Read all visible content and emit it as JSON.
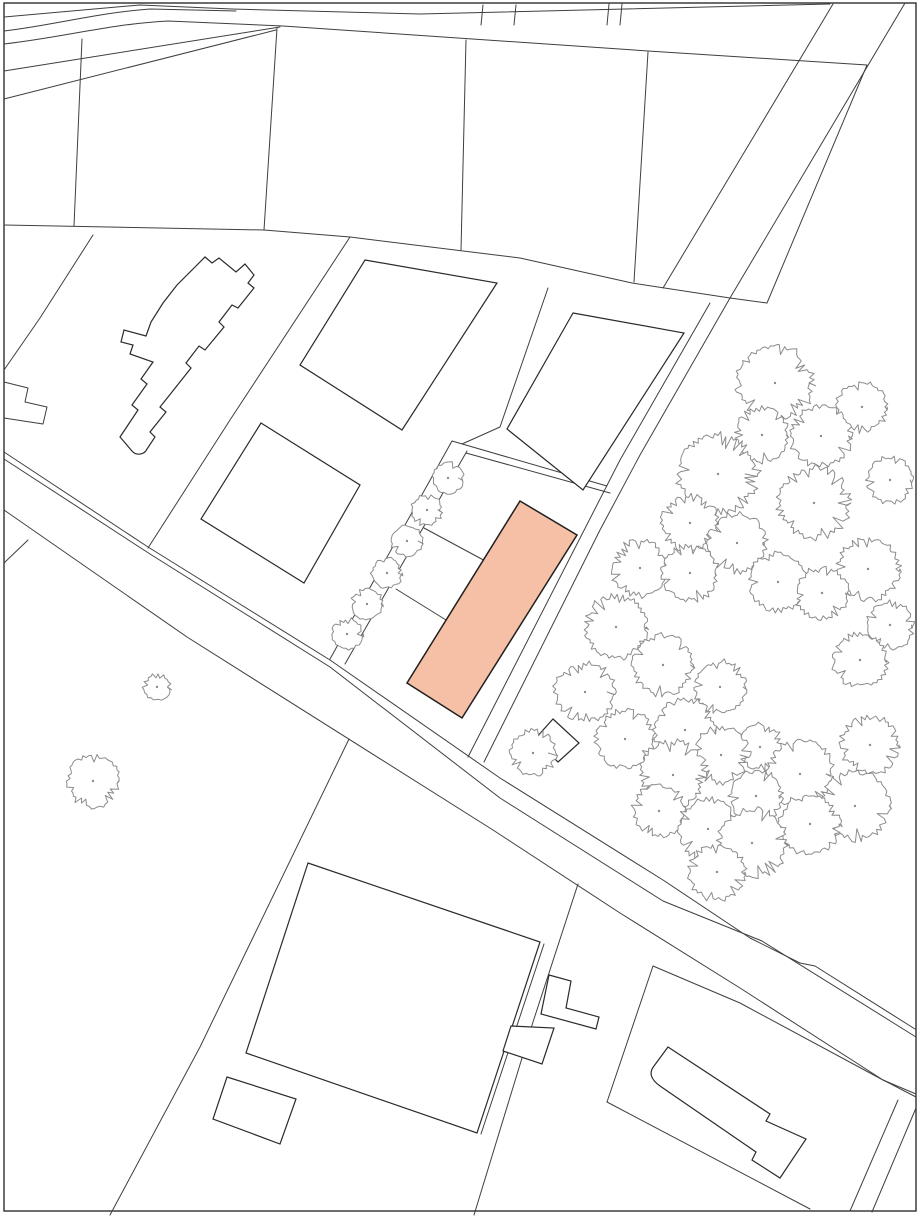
{
  "document": {
    "kind": "cadastral-site-plan",
    "description": "Black-and-white cadastral site plan with parcel boundaries, building footprints, tree symbols and one highlighted building footprint"
  },
  "canvas": {
    "width": 920,
    "height": 1219,
    "background": "#ffffff"
  },
  "palette": {
    "paper": "#ffffff",
    "border": "#2f2f2f",
    "parcel_line": "#3f3f3f",
    "building_stroke": "#2b2b2b",
    "building_fill": "#ffffff",
    "tree_stroke": "#8c8c8c",
    "tree_fill": "#ffffff",
    "highlight_fill": "#f6c0a6",
    "highlight_stroke": "#1f1f1f"
  },
  "border": {
    "x": 4,
    "y": 3,
    "w": 912,
    "h": 1208
  },
  "parcel_lines": [
    {
      "name": "top-road-upper-edge",
      "pts": [
        [
          4,
          17
        ],
        [
          140,
          5
        ],
        [
          232,
          9
        ],
        [
          420,
          14
        ],
        [
          830,
          4
        ]
      ]
    },
    {
      "name": "top-road-curve-1",
      "d": "M4,31 C55,25 95,13 150,9 L236,11"
    },
    {
      "name": "top-road-lower-edge-chain",
      "d": "M4,44 C65,37 110,24 168,21 L283,26 L648,51 L867,65 L767,303"
    },
    {
      "name": "top-left-diagonal-1",
      "pts": [
        [
          4,
          71
        ],
        [
          280,
          27
        ]
      ]
    },
    {
      "name": "top-left-diagonal-2",
      "pts": [
        [
          4,
          99
        ],
        [
          276,
          30
        ]
      ]
    },
    {
      "name": "parcel-divider-v1",
      "pts": [
        [
          82,
          39
        ],
        [
          74,
          226
        ]
      ]
    },
    {
      "name": "parcel-divider-v2",
      "pts": [
        [
          277,
          28
        ],
        [
          264,
          230
        ]
      ]
    },
    {
      "name": "parcel-divider-v3",
      "pts": [
        [
          466,
          40
        ],
        [
          461,
          250
        ]
      ]
    },
    {
      "name": "parcel-divider-v4",
      "pts": [
        [
          648,
          52
        ],
        [
          634,
          282
        ]
      ]
    },
    {
      "name": "tick-1",
      "pts": [
        [
          483,
          5
        ],
        [
          481,
          25
        ]
      ]
    },
    {
      "name": "tick-2",
      "pts": [
        [
          516,
          5
        ],
        [
          514,
          25
        ]
      ]
    },
    {
      "name": "tick-3",
      "pts": [
        [
          609,
          4
        ],
        [
          607,
          25
        ]
      ]
    },
    {
      "name": "tick-4",
      "pts": [
        [
          622,
          4
        ],
        [
          620,
          25
        ]
      ]
    },
    {
      "name": "block-north-boundary",
      "pts": [
        [
          4,
          225
        ],
        [
          264,
          230
        ],
        [
          350,
          237
        ],
        [
          520,
          258
        ],
        [
          632,
          283
        ],
        [
          730,
          298
        ],
        [
          767,
          303
        ]
      ]
    },
    {
      "name": "ne-road-west-edge",
      "pts": [
        [
          833,
          4
        ],
        [
          663,
          288
        ]
      ]
    },
    {
      "name": "ne-road-east-edge",
      "pts": [
        [
          905,
          3
        ],
        [
          730,
          298
        ]
      ]
    },
    {
      "name": "long-sw-boundary",
      "pts": [
        [
          350,
          237
        ],
        [
          230,
          420
        ],
        [
          148,
          548
        ]
      ]
    },
    {
      "name": "building-parcel-west-line",
      "pts": [
        [
          93,
          235
        ],
        [
          40,
          318
        ],
        [
          4,
          370
        ]
      ]
    },
    {
      "name": "left-edge-step-shape",
      "d": "M4,382 L28,388 L25,402 L47,407 L43,424 L4,418"
    },
    {
      "name": "left-edge-short-line",
      "pts": [
        [
          4,
          563
        ],
        [
          28,
          540
        ]
      ]
    },
    {
      "name": "tree-parcel-west-line",
      "pts": [
        [
          730,
          298
        ],
        [
          640,
          455
        ],
        [
          600,
          530
        ],
        [
          484,
          762
        ]
      ]
    },
    {
      "name": "strip-west-line",
      "pts": [
        [
          710,
          303
        ],
        [
          620,
          460
        ],
        [
          468,
          757
        ]
      ]
    },
    {
      "name": "band-upper-line",
      "pts": [
        [
          452,
          441
        ],
        [
          607,
          486
        ]
      ]
    },
    {
      "name": "band-lower-line",
      "pts": [
        [
          466,
          453
        ],
        [
          610,
          493
        ]
      ]
    },
    {
      "name": "tree-row-west-line",
      "pts": [
        [
          452,
          441
        ],
        [
          330,
          659
        ]
      ]
    },
    {
      "name": "tree-row-east-line",
      "pts": [
        [
          467,
          451
        ],
        [
          345,
          664
        ]
      ]
    },
    {
      "name": "middle-divider-1",
      "pts": [
        [
          424,
          528
        ],
        [
          489,
          563
        ]
      ]
    },
    {
      "name": "middle-divider-2",
      "pts": [
        [
          396,
          589
        ],
        [
          446,
          620
        ]
      ]
    },
    {
      "name": "parcel-b-outer-west",
      "pts": [
        [
          548,
          288
        ],
        [
          500,
          427
        ],
        [
          462,
          444
        ]
      ]
    },
    {
      "name": "main-road-top-edge",
      "pts": [
        [
          4,
          452
        ],
        [
          148,
          547
        ],
        [
          330,
          660
        ],
        [
          500,
          778
        ],
        [
          663,
          880
        ],
        [
          750,
          938
        ],
        [
          800,
          963
        ],
        [
          815,
          966
        ],
        [
          915,
          1029
        ]
      ]
    },
    {
      "name": "main-road-top-edge-parallel",
      "pts": [
        [
          4,
          459
        ],
        [
          150,
          554
        ],
        [
          330,
          667
        ],
        [
          500,
          798
        ],
        [
          663,
          901
        ],
        [
          762,
          941
        ],
        [
          916,
          1037
        ]
      ]
    },
    {
      "name": "main-road-bottom-edge",
      "pts": [
        [
          4,
          510
        ],
        [
          187,
          637
        ],
        [
          493,
          830
        ],
        [
          620,
          913
        ],
        [
          740,
          988
        ],
        [
          883,
          1080
        ],
        [
          916,
          1094
        ]
      ]
    },
    {
      "name": "se-parcel-north-line",
      "pts": [
        [
          653,
          966
        ],
        [
          740,
          1003
        ],
        [
          883,
          1080
        ],
        [
          916,
          1097
        ]
      ]
    },
    {
      "name": "se-parcel-west-line",
      "pts": [
        [
          653,
          966
        ],
        [
          607,
          1102
        ]
      ]
    },
    {
      "name": "se-parcel-south-line",
      "pts": [
        [
          607,
          1102
        ],
        [
          810,
          1209
        ]
      ]
    },
    {
      "name": "sw-boundary-lower",
      "pts": [
        [
          349,
          739
        ],
        [
          200,
          1047
        ],
        [
          110,
          1215
        ]
      ]
    },
    {
      "name": "mid-boundary-lower",
      "pts": [
        [
          578,
          884
        ],
        [
          533,
          1022
        ],
        [
          474,
          1215
        ]
      ]
    },
    {
      "name": "br-band-west",
      "pts": [
        [
          898,
          1100
        ],
        [
          850,
          1211
        ]
      ]
    },
    {
      "name": "br-band-east",
      "pts": [
        [
          916,
          1108
        ],
        [
          872,
          1212
        ]
      ]
    },
    {
      "name": "big-building-flank-line",
      "pts": [
        [
          544,
          944
        ],
        [
          481,
          1134
        ]
      ]
    }
  ],
  "buildings": [
    {
      "name": "upper-left-building",
      "d": "M196,266 L205,257 L212,263 L219,258 L236,272 L245,264 L254,275 L248,283 L254,288 L238,308 L232,305 L219,322 L224,327 L205,350 L199,346 L186,363 L191,368 L172,392 L160,407 L166,412 L150,432 L155,437 L147,449 A9,9 0 0 1 132,451 L120,437 L138,410 L132,405 L147,384 L141,379 L153,362 L130,354 L133,345 L121,342 L124,330 L146,336 L151,322 L163,303 L177,285 Z"
    },
    {
      "name": "parcel-quad-a",
      "pts": [
        [
          365,
          260
        ],
        [
          497,
          283
        ],
        [
          402,
          430
        ],
        [
          300,
          365
        ]
      ]
    },
    {
      "name": "parcel-quad-b",
      "pts": [
        [
          573,
          313
        ],
        [
          684,
          333
        ],
        [
          583,
          490
        ],
        [
          507,
          429
        ]
      ]
    },
    {
      "name": "parcel-quad-c",
      "pts": [
        [
          261,
          423
        ],
        [
          360,
          485
        ],
        [
          304,
          583
        ],
        [
          201,
          519
        ]
      ]
    },
    {
      "name": "small-diamond-building",
      "pts": [
        [
          553,
          719
        ],
        [
          579,
          743
        ],
        [
          558,
          762
        ],
        [
          535,
          739
        ]
      ]
    },
    {
      "name": "big-lower-building",
      "pts": [
        [
          308,
          863
        ],
        [
          540,
          942
        ],
        [
          477,
          1133
        ],
        [
          246,
          1053
        ]
      ]
    },
    {
      "name": "small-rect-building",
      "pts": [
        [
          227,
          1077
        ],
        [
          296,
          1099
        ],
        [
          280,
          1144
        ],
        [
          213,
          1119
        ]
      ]
    },
    {
      "name": "l-shaped-annex",
      "d": "M549,975 L571,981 L566,1008 L599,1017 L596,1029 L541,1014 Z"
    },
    {
      "name": "small-quad-annex",
      "pts": [
        [
          511,
          1026
        ],
        [
          554,
          1028
        ],
        [
          542,
          1064
        ],
        [
          503,
          1051
        ]
      ]
    },
    {
      "name": "lower-right-building",
      "d": "M668,1047 L770,1114 L766,1121 L806,1139 L780,1178 L752,1160 L756,1152 L660,1086 Q646,1076 654,1066 Z"
    }
  ],
  "highlight_building": {
    "name": "highlighted-building-footprint",
    "pts": [
      [
        520,
        501
      ],
      [
        577,
        535
      ],
      [
        462,
        718
      ],
      [
        407,
        683
      ]
    ]
  },
  "trees": {
    "row": [
      {
        "x": 448,
        "y": 478,
        "r": 15
      },
      {
        "x": 427,
        "y": 510,
        "r": 15
      },
      {
        "x": 407,
        "y": 541,
        "r": 15
      },
      {
        "x": 387,
        "y": 573,
        "r": 15
      },
      {
        "x": 367,
        "y": 604,
        "r": 15
      },
      {
        "x": 347,
        "y": 634,
        "r": 15
      }
    ],
    "lone": [
      {
        "x": 157,
        "y": 687,
        "r": 13
      },
      {
        "x": 93,
        "y": 781,
        "r": 25
      }
    ],
    "cluster": [
      {
        "x": 775,
        "y": 383,
        "r": 36
      },
      {
        "x": 862,
        "y": 407,
        "r": 24
      },
      {
        "x": 762,
        "y": 435,
        "r": 26
      },
      {
        "x": 821,
        "y": 436,
        "r": 29
      },
      {
        "x": 718,
        "y": 474,
        "r": 38
      },
      {
        "x": 890,
        "y": 480,
        "r": 22
      },
      {
        "x": 814,
        "y": 503,
        "r": 34
      },
      {
        "x": 690,
        "y": 523,
        "r": 27
      },
      {
        "x": 737,
        "y": 543,
        "r": 28
      },
      {
        "x": 868,
        "y": 569,
        "r": 30
      },
      {
        "x": 640,
        "y": 568,
        "r": 27
      },
      {
        "x": 690,
        "y": 573,
        "r": 27
      },
      {
        "x": 778,
        "y": 582,
        "r": 28
      },
      {
        "x": 822,
        "y": 593,
        "r": 25
      },
      {
        "x": 616,
        "y": 627,
        "r": 30
      },
      {
        "x": 890,
        "y": 625,
        "r": 23
      },
      {
        "x": 663,
        "y": 665,
        "r": 29
      },
      {
        "x": 860,
        "y": 660,
        "r": 26
      },
      {
        "x": 585,
        "y": 692,
        "r": 29
      },
      {
        "x": 720,
        "y": 687,
        "r": 25
      },
      {
        "x": 685,
        "y": 730,
        "r": 30
      },
      {
        "x": 625,
        "y": 739,
        "r": 28
      },
      {
        "x": 760,
        "y": 747,
        "r": 22
      },
      {
        "x": 870,
        "y": 745,
        "r": 28
      },
      {
        "x": 721,
        "y": 755,
        "r": 27
      },
      {
        "x": 533,
        "y": 753,
        "r": 22
      },
      {
        "x": 673,
        "y": 775,
        "r": 32
      },
      {
        "x": 800,
        "y": 774,
        "r": 32
      },
      {
        "x": 756,
        "y": 796,
        "r": 25
      },
      {
        "x": 855,
        "y": 806,
        "r": 33
      },
      {
        "x": 659,
        "y": 811,
        "r": 25
      },
      {
        "x": 810,
        "y": 824,
        "r": 29
      },
      {
        "x": 708,
        "y": 829,
        "r": 29
      },
      {
        "x": 752,
        "y": 843,
        "r": 33
      },
      {
        "x": 717,
        "y": 872,
        "r": 27
      }
    ]
  },
  "stroke_widths": {
    "border": 1.4,
    "parcel_line": 1.0,
    "building": 1.2,
    "tree": 1.0,
    "highlight": 1.5
  }
}
